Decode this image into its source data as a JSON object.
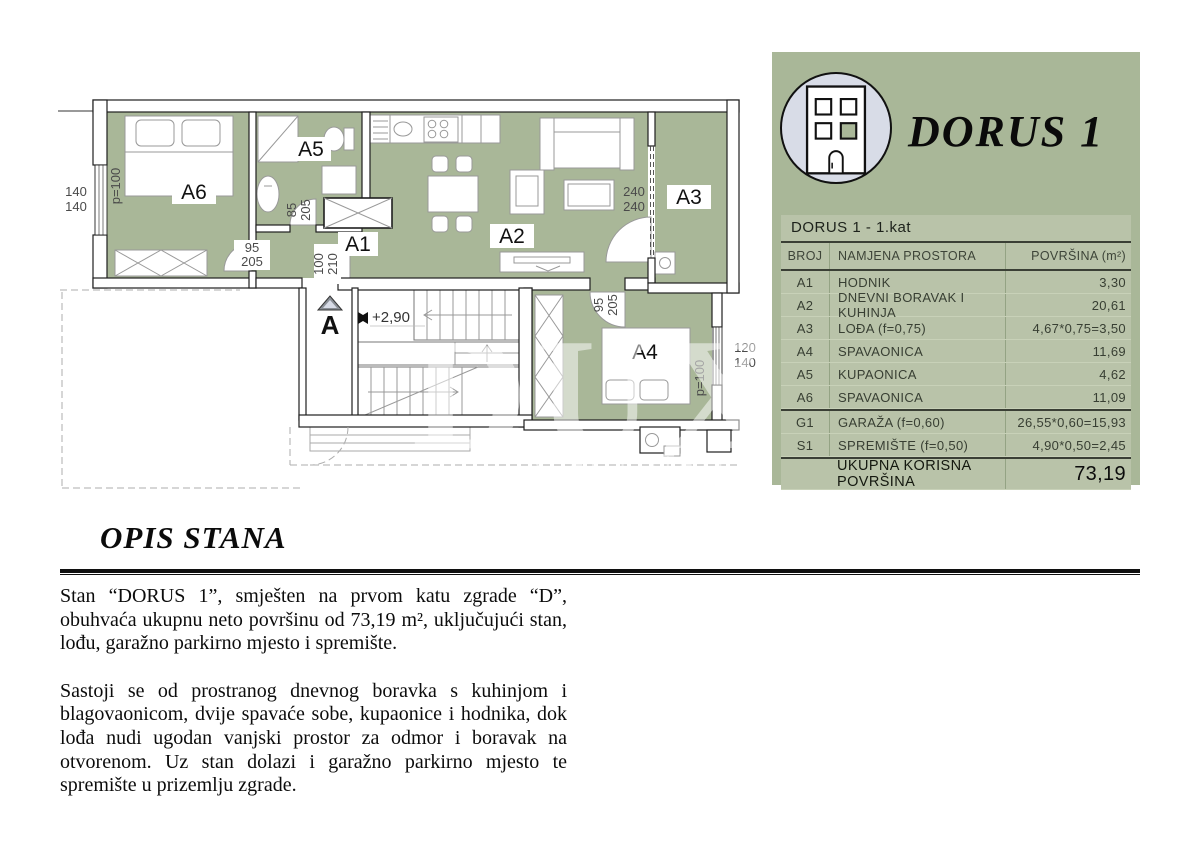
{
  "brand": {
    "title": "DORUS 1"
  },
  "watermark": {
    "brand": "DUX",
    "sub": "REAL ESTATE"
  },
  "colors": {
    "plan_green": "#a9b798",
    "table_row_green": "#b9c3a9",
    "logo_circle": "#d8dce7"
  },
  "table": {
    "title": "DORUS 1 - 1.kat",
    "columns": [
      "BROJ",
      "NAMJENA PROSTORA",
      "POVRŠINA (m²)"
    ],
    "rows": [
      {
        "broj": "A1",
        "namjena": "HODNIK",
        "povrsina": "3,30"
      },
      {
        "broj": "A2",
        "namjena": "DNEVNI BORAVAK I KUHINJA",
        "povrsina": "20,61"
      },
      {
        "broj": "A3",
        "namjena": "LOĐA (f=0,75)",
        "povrsina": "4,67*0,75=3,50"
      },
      {
        "broj": "A4",
        "namjena": "SPAVAONICA",
        "povrsina": "11,69"
      },
      {
        "broj": "A5",
        "namjena": "KUPAONICA",
        "povrsina": "4,62"
      },
      {
        "broj": "A6",
        "namjena": "SPAVAONICA",
        "povrsina": "11,09"
      },
      {
        "broj": "G1",
        "namjena": "GARAŽA (f=0,60)",
        "povrsina": "26,55*0,60=15,93"
      },
      {
        "broj": "S1",
        "namjena": "SPREMIŠTE (f=0,50)",
        "povrsina": "4,90*0,50=2,45"
      }
    ],
    "total_label": "UKUPNA KORISNA POVRŠINA",
    "total_value": "73,19"
  },
  "plan": {
    "rooms": {
      "a1": "A1",
      "a2": "A2",
      "a3": "A3",
      "a4": "A4",
      "a5": "A5",
      "a6": "A6"
    },
    "dims": {
      "win_left": [
        "140",
        "140"
      ],
      "parapet_left": "p=100",
      "door_a6": [
        "95",
        "205"
      ],
      "door_a5": [
        "85",
        "205"
      ],
      "door_entry": [
        "100",
        "210"
      ],
      "door_a3": [
        "240",
        "240"
      ],
      "door_a4": [
        "95",
        "205"
      ],
      "win_right": [
        "120",
        "140"
      ],
      "parapet_right": "p=100",
      "level": "+2,90",
      "section": "A"
    }
  },
  "description": {
    "heading": "OPIS STANA",
    "p1": "Stan “DORUS 1”, smješten na prvom katu zgrade “D”, obuhvaća ukupnu neto površinu od 73,19 m², uključujući stan, lođu, garažno parkirno mjesto i spremište.",
    "p2": "Sastoji se od prostranog dnevnog boravka s kuhinjom i blagovaonicom, dvije spavaće sobe, kupaonice i hodnika, dok lođa nudi ugodan vanjski prostor za odmor i boravak na otvorenom. Uz stan dolazi i garažno parkirno mjesto te spremište u prizemlju zgrade."
  }
}
